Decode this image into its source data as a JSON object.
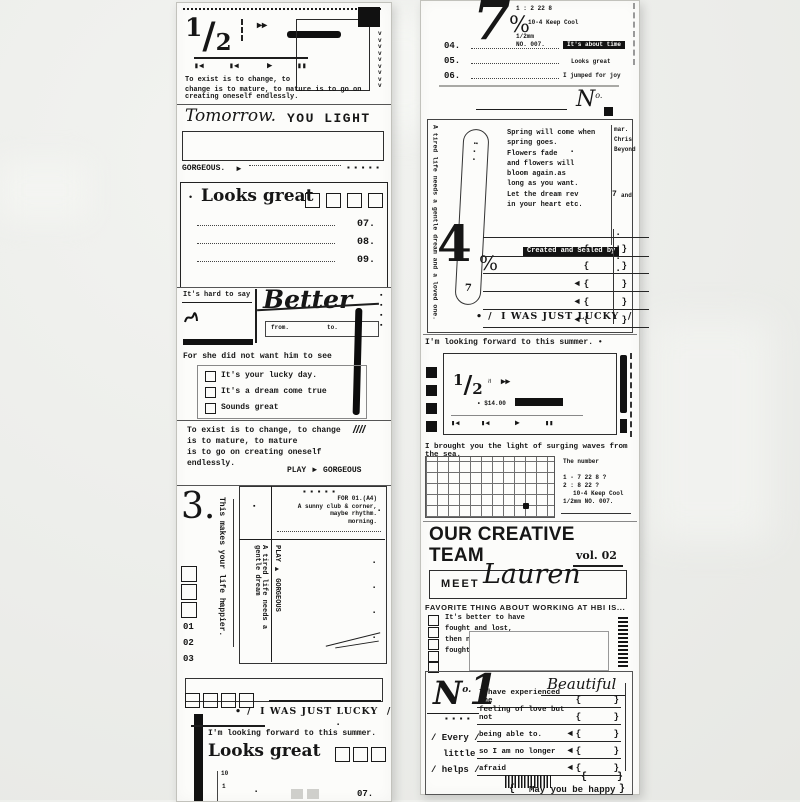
{
  "symbols": {
    "skip_icon": "▮◀",
    "play_icon": "▶",
    "pause_icon": "▮▮",
    "ffwd_icon": "▸▸",
    "arrow_right": "►",
    "arrow_left": "◄",
    "brace_pair": "{      }",
    "bullet": "•",
    "sq": "▪",
    "sq_dots_5": "▪  ▪  ▪  ▪  ▪",
    "sq_dots_4": "▪  ▪  ▪  ▪",
    "sq_col_4": "▪\n▪\n▪\n▪",
    "chevrons": "v\nv\nv\nv\nv\nv\nv\nv\nv",
    "slashes": "////",
    "squiggle": "≈",
    "pill_dots": "▪▪\n▪\n▪"
  },
  "left": {
    "s1": {
      "num": "1",
      "den": "2",
      "line1": "To exist is to change, to",
      "line2": "change is to mature, to mature is to go on creating oneself endlessly."
    },
    "s2": {
      "script": "Tomorrow.",
      "caps": "YOU LIGHT",
      "gorgeous": "GORGEOUS."
    },
    "s3": {
      "title": "Looks great",
      "rows": [
        "07.",
        "08.",
        "09."
      ]
    },
    "s4": {
      "hard": "It's hard to say",
      "script": "Better",
      "from_label": "from.",
      "to_label": "to.",
      "sentence": "For she did not want him to see",
      "options": [
        "It's your lucky day.",
        "It's a dream come true",
        "Sounds great"
      ]
    },
    "s5": {
      "lines": [
        "To exist is to change, to change",
        "is to mature, to mature",
        "is to go on creating oneself",
        "endlessly."
      ],
      "play": "PLAY",
      "gorgeous": "GORGEOUS"
    },
    "s6": {
      "num": "3.",
      "vertical": "This makes your life happier.",
      "nums": [
        "01",
        "02",
        "03"
      ],
      "header": [
        "FOR 01.(A4)",
        "A sunny club & corner,",
        "maybe rhythm.",
        "morning."
      ],
      "vtext1": "A tired life needs a gentle dream",
      "vtext2": "PLAY ► GORGEOUS"
    },
    "s7": {
      "lucky": "/  I WAS JUST LUCKY  /",
      "summer": "I'm looking forward to this summer.",
      "title": "Looks great",
      "tick_top": "10",
      "tick_bottom": "1",
      "row": "07."
    }
  },
  "right": {
    "s1": {
      "num": "7",
      "pct": "%",
      "meta": [
        "1 : 2 22 8",
        "10-4 Keep Cool",
        "1/2mm",
        "NO. 007."
      ],
      "items": [
        {
          "n": "04.",
          "label": "It's about time"
        },
        {
          "n": "05.",
          "label": "Looks great"
        },
        {
          "n": "06.",
          "label": "I jumped for joy"
        }
      ],
      "no": "N",
      "no_sup": "o."
    },
    "s2": {
      "vertical": "A tired life needs a gentle dream and a loved one.",
      "poem": [
        "Spring will come when",
        "spring goes.",
        "Flowers fade",
        "and flowers will",
        "bloom again.as",
        "long as you want.",
        "Let the dream rev",
        "in your heart etc."
      ],
      "pill_num": "7",
      "side": [
        "mar.",
        "Chris",
        "Beyond"
      ],
      "side_num": "7",
      "side_word": "and",
      "sealed": "Created and Sealed by",
      "num": "4",
      "pct": "%",
      "lucky": "/  I WAS JUST LUCKY  /"
    },
    "s3": {
      "summer": "I'm looking forward to this summer. •",
      "num": "1",
      "den": "2",
      "price": "• $14.00"
    },
    "s4": {
      "caption": "I brought you the light of surging waves from the sea.",
      "side": [
        "The number",
        "1 - 7 22 8 ?",
        "2 : 8 22 ?",
        "10-4 Keep Cool",
        "1/2mm  NO. 007."
      ]
    },
    "s5": {
      "title1": "OUR CREATIVE",
      "title2": "TEAM",
      "vol": "vol. 02",
      "meet": "MEET",
      "name": "Lauren"
    },
    "s6": {
      "heading": "FAVORITE THING ABOUT WORKING AT HBI IS...",
      "lines": [
        "It's better to have",
        "fought and lost,",
        "then never to have",
        "fought at all."
      ]
    },
    "s7": {
      "no": "N",
      "no_sup": "o.",
      "one": "1",
      "beautiful": "Beautiful",
      "rows": [
        "I have experienced the",
        "feeling of love but not",
        "being able to.",
        "so I am no longer",
        "afraid"
      ],
      "every": "/ Every /",
      "little": "little",
      "helps": "/ helps /",
      "happy": "May you be happy",
      "brace_l": "{",
      "brace_r": "}"
    }
  }
}
